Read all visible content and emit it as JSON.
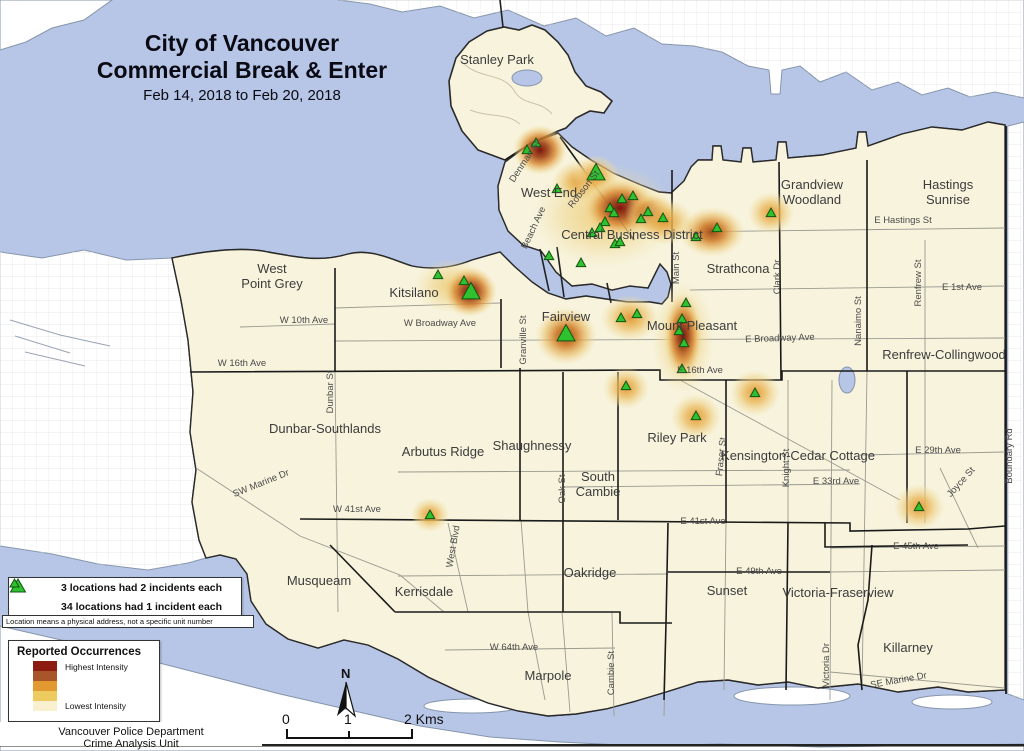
{
  "title": {
    "line1": "City of Vancouver",
    "line2": "Commercial Break & Enter",
    "date_range": "Feb 14, 2018 to Feb 20, 2018"
  },
  "incident_legend": {
    "items": [
      {
        "symbol": "large-green-triangle",
        "label": "3 locations had 2 incidents each"
      },
      {
        "symbol": "small-green-triangle",
        "label": "34 locations had 1 incident each"
      }
    ],
    "note": "Location means a physical address, not a specific unit number"
  },
  "intensity_legend": {
    "title": "Reported Occurrences",
    "high_label": "Highest Intensity",
    "low_label": "Lowest Intensity",
    "ramp": [
      "#8c1c10",
      "#a8552a",
      "#e2992f",
      "#edcb5e",
      "#f8f0cf"
    ]
  },
  "attribution": {
    "line1": "Vancouver Police Department",
    "line2": "Crime Analysis Unit"
  },
  "scale_bar": {
    "labels": [
      "0",
      "1",
      "2 Kms"
    ],
    "north_label": "N"
  },
  "map": {
    "colors": {
      "water": "#b7c6e6",
      "city_land": "#f7f3dc",
      "outside_land": "#ffffff",
      "boundary": "#1a1a1a",
      "triangle_fill": "#2ec22e",
      "triangle_stroke": "#145214"
    },
    "neighborhoods": [
      {
        "lines": [
          "Stanley Park"
        ],
        "x": 497,
        "y": 64
      },
      {
        "lines": [
          "West End"
        ],
        "x": 549,
        "y": 197
      },
      {
        "lines": [
          "Central Business District"
        ],
        "x": 632,
        "y": 239
      },
      {
        "lines": [
          "Strathcona"
        ],
        "x": 738,
        "y": 273
      },
      {
        "lines": [
          "Grandview",
          "Woodland"
        ],
        "x": 812,
        "y": 189
      },
      {
        "lines": [
          "Hastings",
          "Sunrise"
        ],
        "x": 948,
        "y": 189
      },
      {
        "lines": [
          "West",
          "Point Grey"
        ],
        "x": 272,
        "y": 273
      },
      {
        "lines": [
          "Kitsilano"
        ],
        "x": 414,
        "y": 297
      },
      {
        "lines": [
          "Fairview"
        ],
        "x": 566,
        "y": 321
      },
      {
        "lines": [
          "Mount Pleasant"
        ],
        "x": 692,
        "y": 330
      },
      {
        "lines": [
          "Renfrew-Collingwood"
        ],
        "x": 944,
        "y": 359
      },
      {
        "lines": [
          "Dunbar-Southlands"
        ],
        "x": 325,
        "y": 433
      },
      {
        "lines": [
          "Arbutus Ridge"
        ],
        "x": 443,
        "y": 456
      },
      {
        "lines": [
          "Shaughnessy"
        ],
        "x": 532,
        "y": 450
      },
      {
        "lines": [
          "South",
          "Cambie"
        ],
        "x": 598,
        "y": 481
      },
      {
        "lines": [
          "Riley Park"
        ],
        "x": 677,
        "y": 442
      },
      {
        "lines": [
          "Kensington-Cedar Cottage"
        ],
        "x": 798,
        "y": 460
      },
      {
        "lines": [
          "Musqueam"
        ],
        "x": 319,
        "y": 585
      },
      {
        "lines": [
          "Kerrisdale"
        ],
        "x": 424,
        "y": 596
      },
      {
        "lines": [
          "Oakridge"
        ],
        "x": 590,
        "y": 577
      },
      {
        "lines": [
          "Sunset"
        ],
        "x": 727,
        "y": 595
      },
      {
        "lines": [
          "Victoria-Fraserview"
        ],
        "x": 838,
        "y": 597
      },
      {
        "lines": [
          "Killarney"
        ],
        "x": 908,
        "y": 652
      },
      {
        "lines": [
          "Marpole"
        ],
        "x": 548,
        "y": 680
      }
    ],
    "streets": [
      {
        "name": "Denman St",
        "x": 527,
        "y": 163,
        "rot": -57
      },
      {
        "name": "Robson St",
        "x": 586,
        "y": 191,
        "rot": -52
      },
      {
        "name": "Beach Ave",
        "x": 536,
        "y": 229,
        "rot": -65
      },
      {
        "name": "Main St",
        "x": 679,
        "y": 268,
        "rot": -90
      },
      {
        "name": "Clark Dr",
        "x": 780,
        "y": 277,
        "rot": -90
      },
      {
        "name": "Nanaimo St",
        "x": 861,
        "y": 321,
        "rot": -90
      },
      {
        "name": "Renfrew St",
        "x": 921,
        "y": 283,
        "rot": -90
      },
      {
        "name": "Boundary Rd",
        "x": 1012,
        "y": 456,
        "rot": -90
      },
      {
        "name": "E Hastings St",
        "x": 903,
        "y": 223,
        "rot": 0
      },
      {
        "name": "E 1st Ave",
        "x": 962,
        "y": 290,
        "rot": 0
      },
      {
        "name": "W 10th Ave",
        "x": 304,
        "y": 323,
        "rot": 0
      },
      {
        "name": "W Broadway Ave",
        "x": 440,
        "y": 326,
        "rot": 0
      },
      {
        "name": "E Broadway Ave",
        "x": 780,
        "y": 341,
        "rot": -2
      },
      {
        "name": "W 16th Ave",
        "x": 242,
        "y": 366,
        "rot": 0
      },
      {
        "name": "E 16th Ave",
        "x": 700,
        "y": 373,
        "rot": 0
      },
      {
        "name": "Granville St",
        "x": 526,
        "y": 340,
        "rot": -90
      },
      {
        "name": "Dunbar St",
        "x": 333,
        "y": 392,
        "rot": -90
      },
      {
        "name": "Oak St",
        "x": 565,
        "y": 489,
        "rot": -90
      },
      {
        "name": "SW Marine Dr",
        "x": 262,
        "y": 486,
        "rot": -22
      },
      {
        "name": "W 41st Ave",
        "x": 357,
        "y": 512,
        "rot": 0
      },
      {
        "name": "E 41st Ave",
        "x": 703,
        "y": 524,
        "rot": 0
      },
      {
        "name": "West Blvd",
        "x": 456,
        "y": 547,
        "rot": -80
      },
      {
        "name": "E 29th Ave",
        "x": 938,
        "y": 453,
        "rot": 0
      },
      {
        "name": "E 33rd Ave",
        "x": 836,
        "y": 484,
        "rot": 0
      },
      {
        "name": "Knight St",
        "x": 789,
        "y": 468,
        "rot": -90
      },
      {
        "name": "Fraser St",
        "x": 724,
        "y": 457,
        "rot": -84
      },
      {
        "name": "Joyce St",
        "x": 963,
        "y": 484,
        "rot": -48
      },
      {
        "name": "E 45th Ave",
        "x": 916,
        "y": 549,
        "rot": 0
      },
      {
        "name": "E 49th Ave",
        "x": 759,
        "y": 574,
        "rot": 0
      },
      {
        "name": "W 64th Ave",
        "x": 514,
        "y": 650,
        "rot": 0
      },
      {
        "name": "Cambie St",
        "x": 614,
        "y": 673,
        "rot": -90
      },
      {
        "name": "Victoria Dr",
        "x": 829,
        "y": 665,
        "rot": -90
      },
      {
        "name": "SE Marine Dr",
        "x": 899,
        "y": 683,
        "rot": -10
      }
    ],
    "incidents": {
      "large": [
        [
          596,
          173
        ],
        [
          471,
          292
        ],
        [
          566,
          334
        ]
      ],
      "small": [
        [
          536,
          143
        ],
        [
          527,
          150
        ],
        [
          557,
          189
        ],
        [
          605,
          222
        ],
        [
          622,
          199
        ],
        [
          633,
          196
        ],
        [
          610,
          208
        ],
        [
          614,
          213
        ],
        [
          641,
          219
        ],
        [
          648,
          212
        ],
        [
          663,
          218
        ],
        [
          592,
          233
        ],
        [
          600,
          228
        ],
        [
          615,
          244
        ],
        [
          620,
          242
        ],
        [
          549,
          256
        ],
        [
          581,
          263
        ],
        [
          717,
          228
        ],
        [
          696,
          237
        ],
        [
          771,
          213
        ],
        [
          438,
          275
        ],
        [
          464,
          281
        ],
        [
          621,
          318
        ],
        [
          637,
          314
        ],
        [
          686,
          303
        ],
        [
          682,
          319
        ],
        [
          679,
          331
        ],
        [
          684,
          343
        ],
        [
          682,
          369
        ],
        [
          626,
          386
        ],
        [
          755,
          393
        ],
        [
          696,
          416
        ],
        [
          430,
          515
        ],
        [
          919,
          507
        ]
      ]
    },
    "heat_spots": [
      {
        "x": 605,
        "y": 215,
        "rx": 72,
        "ry": 52,
        "level": 1
      },
      {
        "x": 580,
        "y": 182,
        "rx": 28,
        "ry": 22,
        "level": 2
      },
      {
        "x": 540,
        "y": 150,
        "rx": 27,
        "ry": 25,
        "level": 4
      },
      {
        "x": 596,
        "y": 176,
        "rx": 23,
        "ry": 21,
        "level": 2
      },
      {
        "x": 620,
        "y": 208,
        "rx": 37,
        "ry": 29,
        "level": 4
      },
      {
        "x": 650,
        "y": 214,
        "rx": 25,
        "ry": 21,
        "level": 3
      },
      {
        "x": 665,
        "y": 222,
        "rx": 29,
        "ry": 23,
        "level": 2
      },
      {
        "x": 712,
        "y": 232,
        "rx": 33,
        "ry": 25,
        "level": 3
      },
      {
        "x": 771,
        "y": 213,
        "rx": 23,
        "ry": 21,
        "level": 2
      },
      {
        "x": 452,
        "y": 286,
        "rx": 38,
        "ry": 27,
        "level": 1
      },
      {
        "x": 470,
        "y": 292,
        "rx": 27,
        "ry": 25,
        "level": 4
      },
      {
        "x": 566,
        "y": 336,
        "rx": 31,
        "ry": 29,
        "level": 3
      },
      {
        "x": 630,
        "y": 318,
        "rx": 29,
        "ry": 23,
        "level": 2
      },
      {
        "x": 683,
        "y": 338,
        "rx": 31,
        "ry": 56,
        "level": 1
      },
      {
        "x": 683,
        "y": 336,
        "rx": 19,
        "ry": 43,
        "level": 4
      },
      {
        "x": 626,
        "y": 388,
        "rx": 23,
        "ry": 21,
        "level": 2
      },
      {
        "x": 755,
        "y": 393,
        "rx": 25,
        "ry": 23,
        "level": 2
      },
      {
        "x": 696,
        "y": 417,
        "rx": 25,
        "ry": 23,
        "level": 2
      },
      {
        "x": 430,
        "y": 515,
        "rx": 19,
        "ry": 17,
        "level": 2
      },
      {
        "x": 919,
        "y": 507,
        "rx": 25,
        "ry": 23,
        "level": 2
      }
    ]
  }
}
